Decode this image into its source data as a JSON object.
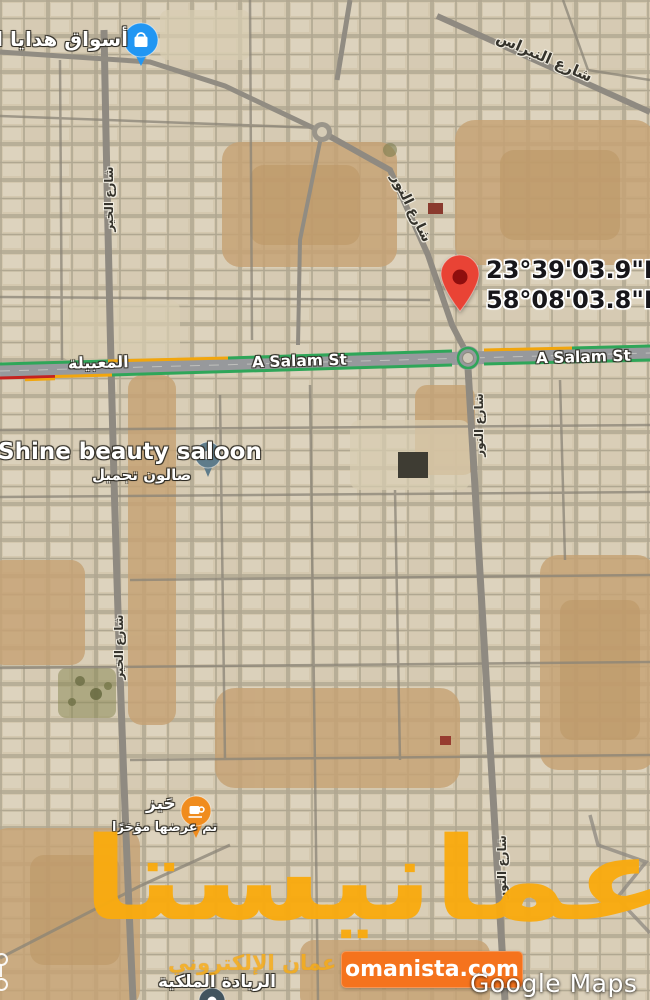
{
  "labels": {
    "gift_market": "أسواق هدايا الع",
    "nibras_street": "شارع النبراس",
    "noor_street_diagonal": "شارع النور",
    "noor_street_vertical_1": "شارع النور",
    "noor_street_vertical_2": "شارع النور",
    "khair_street_vertical_1": "شارع الخير",
    "khair_street_vertical_2": "شارع الخير",
    "maabilah": "المعبيلة",
    "a_salam_street_1": "A Salam St",
    "a_salam_street_2": "A Salam St",
    "salon_name": "Shine beauty saloon",
    "salon_subtitle": "صالون تجميل",
    "hayz_name": "حَيز",
    "hayz_subtitle": "تم عرضها مؤخرًا",
    "royal_leadership": "الريادة الملكية"
  },
  "dropped_pin": {
    "coord_line1": "23°39'03.9\"N",
    "coord_line2": "58°08'03.8\"E"
  },
  "watermark": {
    "title": "عمانيستا",
    "subtitle": "سوق عمان الإلكتروني",
    "badge": "omanista.com"
  },
  "attribution": "Google Maps",
  "icons": {
    "shop_pin": "shopping-bag-icon",
    "salon_pin": "dot-icon",
    "cafe_pin": "coffee-cup-icon",
    "dropped_pin": "location-pin-icon"
  },
  "colors": {
    "watermark_orange": "#F9AB10",
    "badge_orange": "#F5731D",
    "pin_red": "#E94335",
    "pin_red_dark": "#8F0E0E",
    "shop_pin_blue": "#2196F3",
    "cafe_pin_orange": "#F08C1E",
    "salon_pin_slate": "#5E7C8B",
    "traffic_green": "#2FA659",
    "traffic_yellow": "#F2A60D",
    "traffic_red": "#C5221F"
  }
}
